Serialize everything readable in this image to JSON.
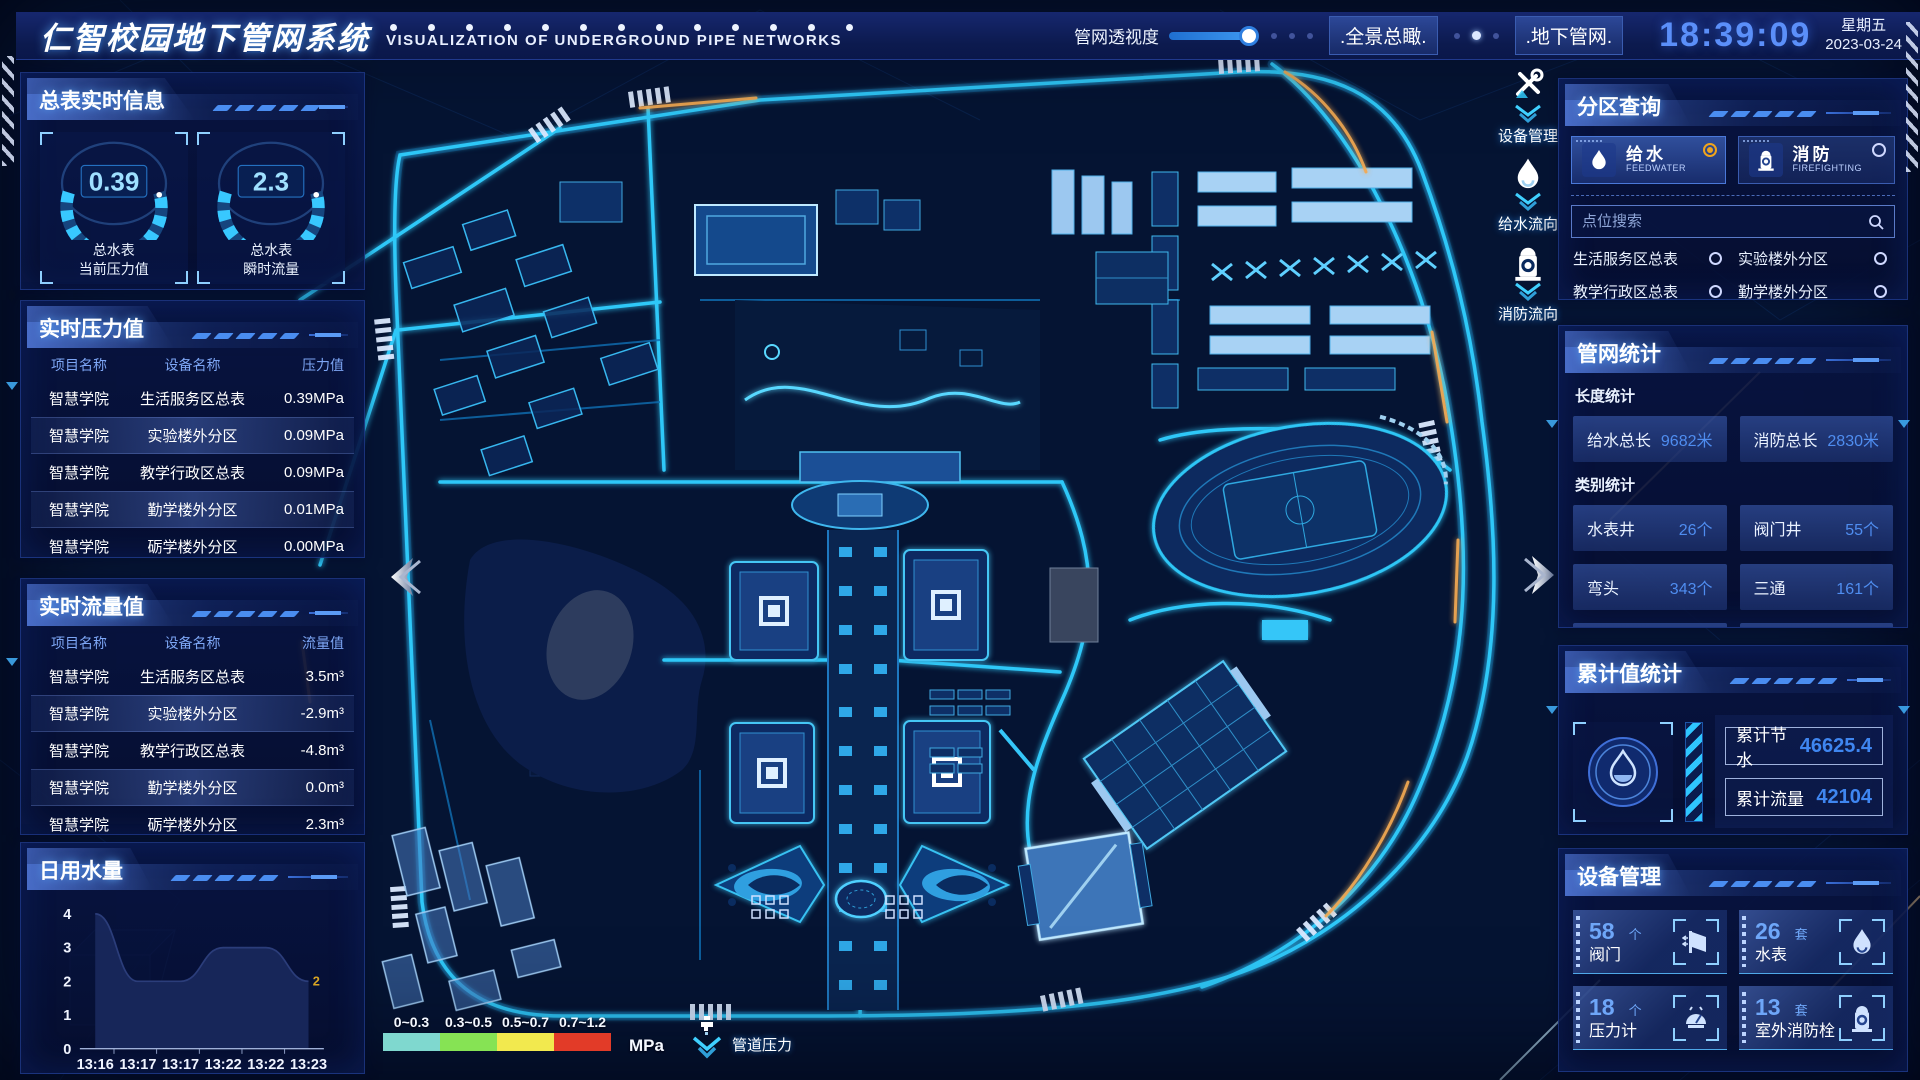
{
  "header": {
    "title": "仁智校园地下管网系统",
    "subtitle": "VISUALIZATION OF UNDERGROUND PIPE NETWORKS",
    "slider_label": "管网透视度",
    "slider_value_pct": 92,
    "buttons": [
      {
        "label": ".全景总瞰."
      },
      {
        "label": ".地下管网."
      }
    ],
    "time": "18:39:09",
    "weekday": "星期五",
    "date": "2023-03-24"
  },
  "panels": {
    "meter_info": {
      "title": "总表实时信息",
      "gauges": [
        {
          "value": "0.39",
          "label_line1": "总水表",
          "label_line2": "当前压力值"
        },
        {
          "value": "2.3",
          "label_line1": "总水表",
          "label_line2": "瞬时流量"
        }
      ]
    },
    "pressure": {
      "title": "实时压力值",
      "columns": [
        "项目名称",
        "设备名称",
        "压力值"
      ],
      "rows": [
        [
          "智慧学院",
          "生活服务区总表",
          "0.39MPa"
        ],
        [
          "智慧学院",
          "实验楼外分区",
          "0.09MPa"
        ],
        [
          "智慧学院",
          "教学行政区总表",
          "0.09MPa"
        ],
        [
          "智慧学院",
          "勤学楼外分区",
          "0.01MPa"
        ],
        [
          "智慧学院",
          "砺学楼外分区",
          "0.00MPa"
        ]
      ]
    },
    "flow": {
      "title": "实时流量值",
      "columns": [
        "项目名称",
        "设备名称",
        "流量值"
      ],
      "rows": [
        [
          "智慧学院",
          "生活服务区总表",
          "3.5m³"
        ],
        [
          "智慧学院",
          "实验楼外分区",
          "-2.9m³"
        ],
        [
          "智慧学院",
          "教学行政区总表",
          "-4.8m³"
        ],
        [
          "智慧学院",
          "勤学楼外分区",
          "0.0m³"
        ],
        [
          "智慧学院",
          "砺学楼外分区",
          "2.3m³"
        ]
      ]
    },
    "daily_water": {
      "title": "日用水量"
    },
    "zone_query": {
      "title": "分区查询",
      "tabs": [
        {
          "label": "给水",
          "sub": "FEEDWATER",
          "selected": true
        },
        {
          "label": "消防",
          "sub": "FIREFIGHTING",
          "selected": false
        }
      ],
      "search_placeholder": "点位搜索",
      "points": [
        "生活服务区总表",
        "实验楼外分区",
        "教学行政区总表",
        "勤学楼外分区",
        "砺学楼外分区",
        "宿舍区泵房"
      ]
    },
    "pipe_stats": {
      "title": "管网统计",
      "length_label": "长度统计",
      "length_items": [
        {
          "name": "给水总长",
          "value": "9682米"
        },
        {
          "name": "消防总长",
          "value": "2830米"
        }
      ],
      "category_label": "类别统计",
      "category_items": [
        {
          "name": "水表井",
          "value": "26个"
        },
        {
          "name": "阀门井",
          "value": "55个"
        },
        {
          "name": "弯头",
          "value": "343个"
        },
        {
          "name": "三通",
          "value": "161个"
        }
      ]
    },
    "cumulative": {
      "title": "累计值统计",
      "items": [
        {
          "name": "累计节水",
          "value": "46625.4"
        },
        {
          "name": "累计流量",
          "value": "42104"
        }
      ]
    },
    "devices": {
      "title": "设备管理",
      "items": [
        {
          "count": "58",
          "unit": "个",
          "name": "阀门",
          "icon": "valve-icon"
        },
        {
          "count": "26",
          "unit": "套",
          "name": "水表",
          "icon": "water-meter-icon"
        },
        {
          "count": "18",
          "unit": "个",
          "name": "压力计",
          "icon": "pressure-gauge-icon"
        },
        {
          "count": "13",
          "unit": "套",
          "name": "室外消防栓",
          "icon": "hydrant-icon"
        }
      ]
    }
  },
  "map": {
    "markers": [
      {
        "label": "设备管理",
        "icon": "tools-icon"
      },
      {
        "label": "给水流向",
        "icon": "water-drop-icon"
      },
      {
        "label": "消防流向",
        "icon": "hydrant-icon"
      }
    ],
    "legend": {
      "items": [
        {
          "label": "0~0.3",
          "color": "#7fd8cf"
        },
        {
          "label": "0.3~0.5",
          "color": "#86e354"
        },
        {
          "label": "0.5~0.7",
          "color": "#f2e94e"
        },
        {
          "label": "0.7~1.2",
          "color": "#e23b28"
        }
      ],
      "unit": "MPa",
      "caption": "管道压力",
      "caption_icon": "faucet-icon"
    }
  },
  "chart_data": {
    "type": "area",
    "title": "日用水量",
    "x": [
      "13:16",
      "13:17",
      "13:17",
      "13:22",
      "13:22",
      "13:23"
    ],
    "values": [
      4,
      2,
      2,
      3,
      3,
      2
    ],
    "ylim": [
      0,
      4
    ],
    "yticks": [
      0,
      1,
      2,
      3,
      4
    ],
    "end_label": "2",
    "end_label_color": "#d9a524",
    "grid": false,
    "legend_position": "none"
  },
  "colors": {
    "accent_cyan": "#2fc8f8",
    "accent_blue": "#5b8ff5",
    "selected_radio": "#f0a41c",
    "time_text": "#5b8ff9",
    "value_blue": "#4f8df0",
    "panel_border": "#24448f",
    "row_highlight": "#5c80dc",
    "chart_end_label": "#d9a524"
  }
}
